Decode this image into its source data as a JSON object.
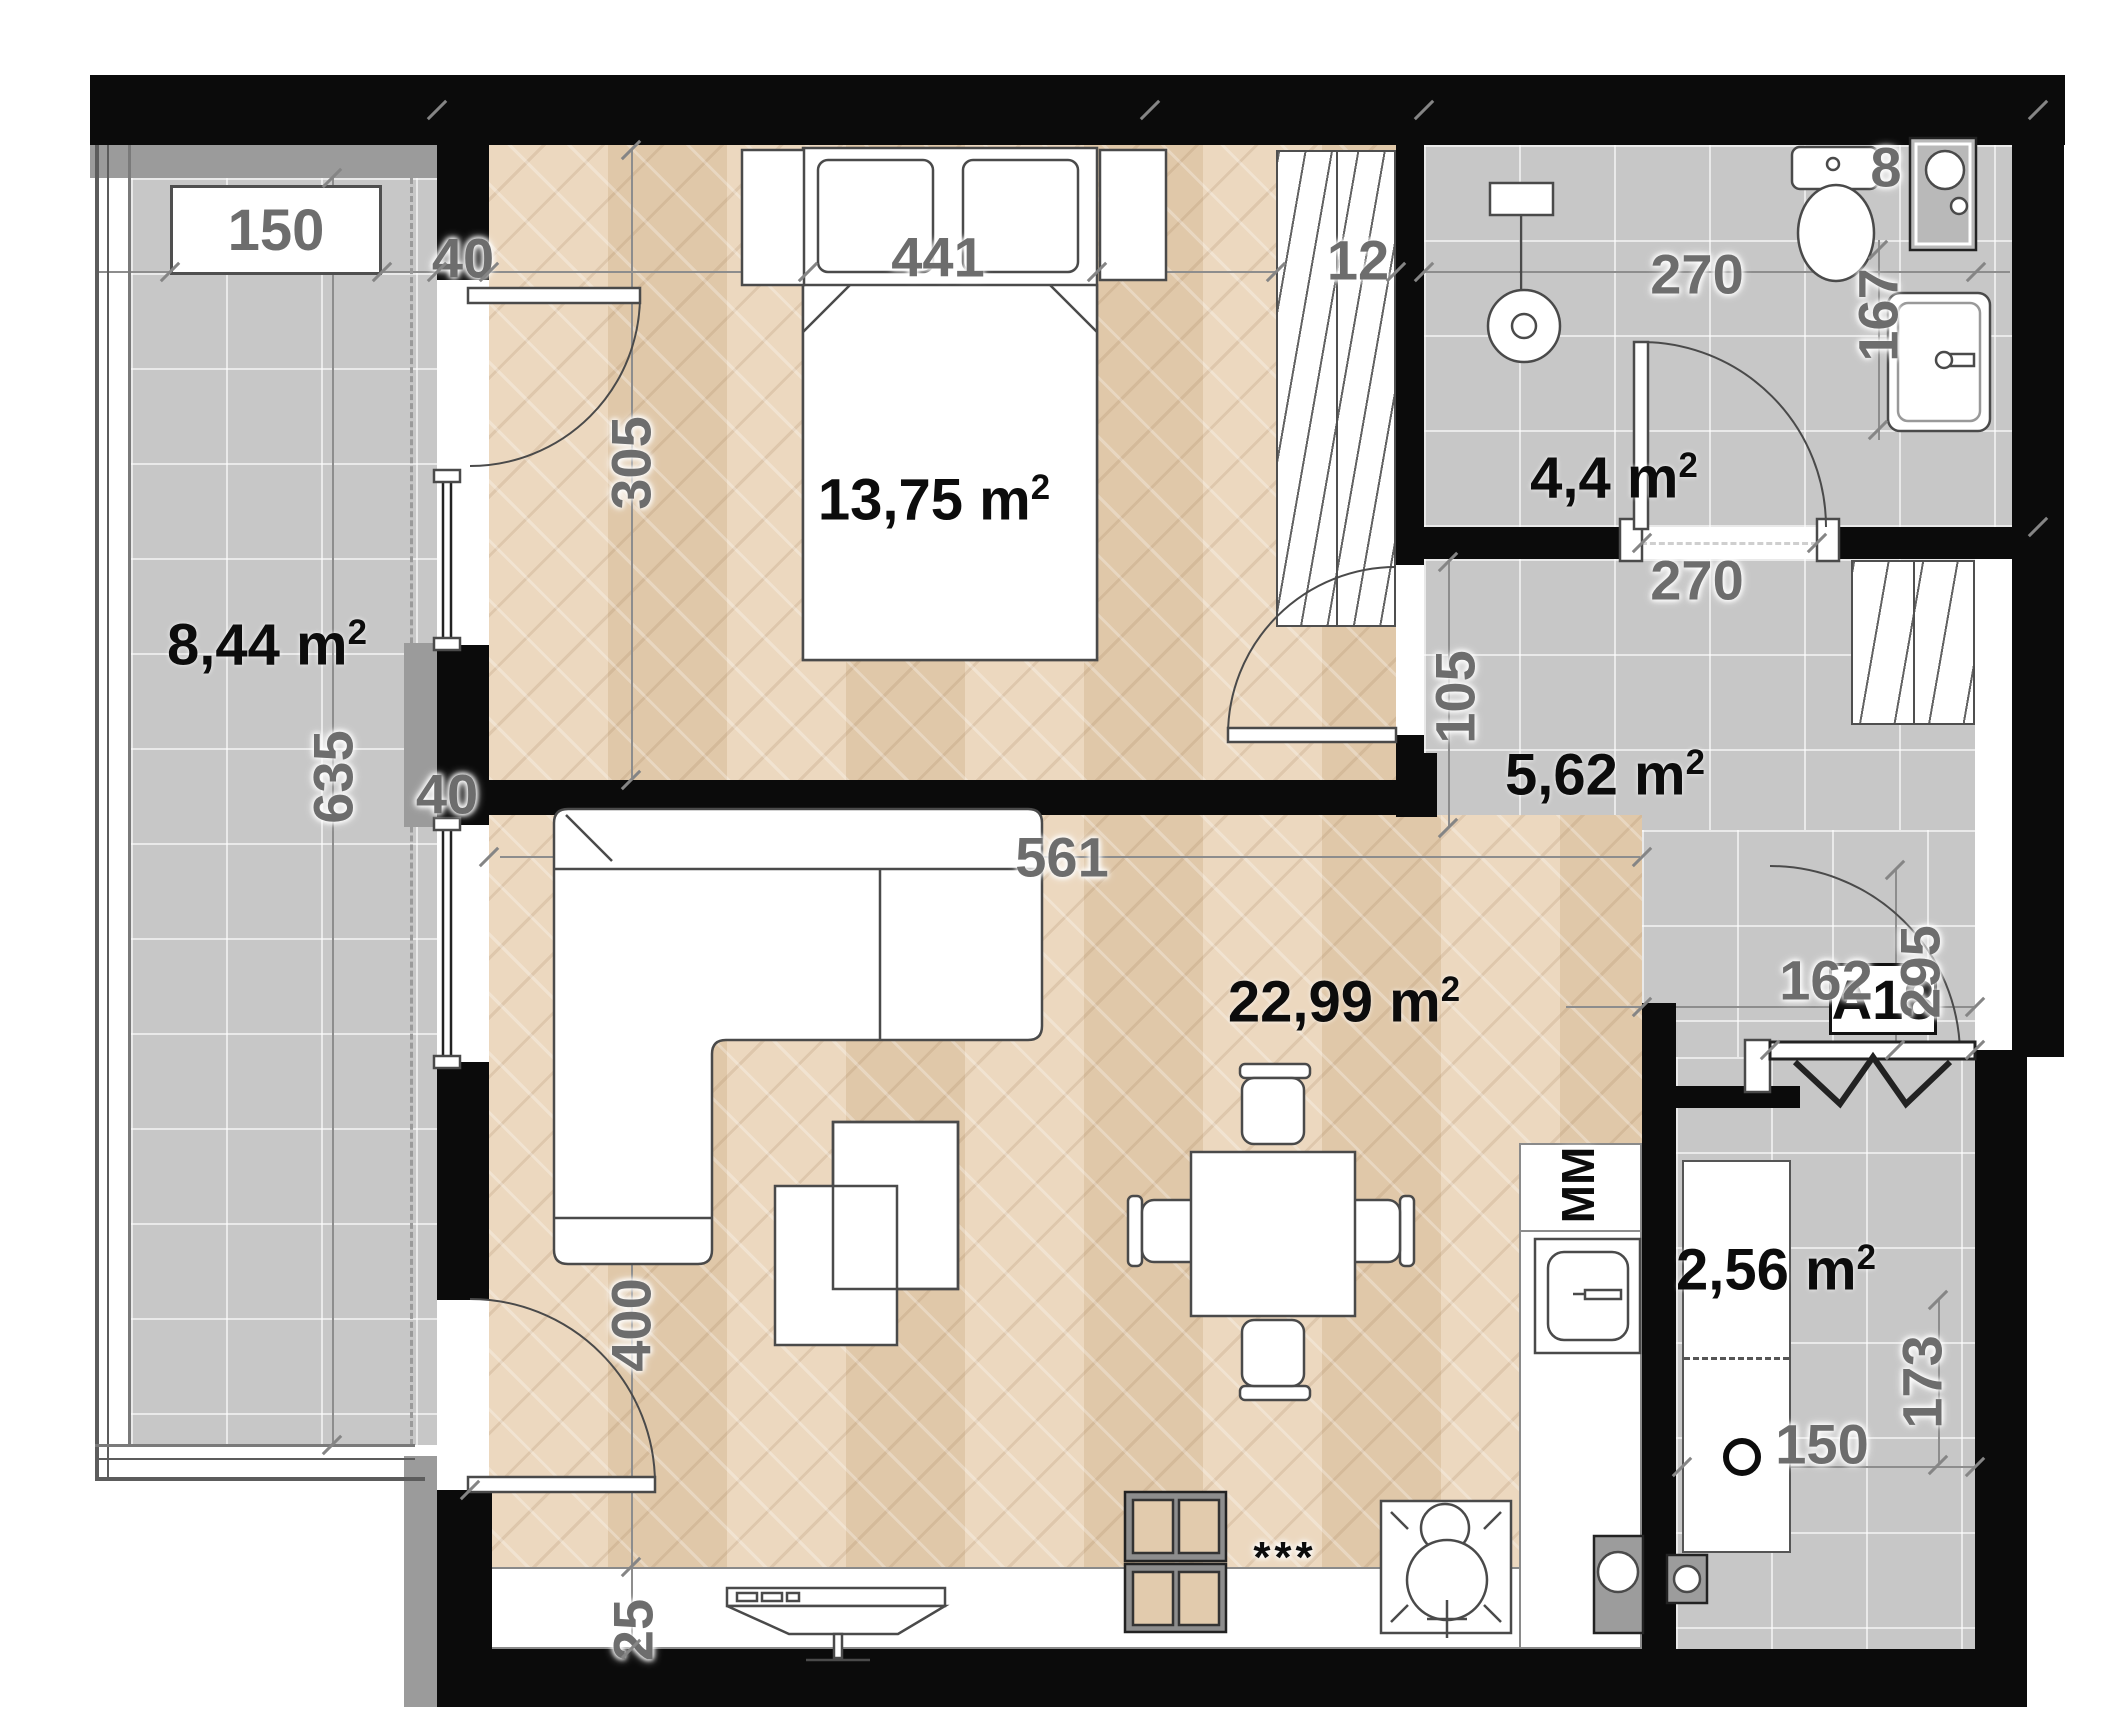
{
  "unit": {
    "label": "A18"
  },
  "balcony_box": {
    "label": "150"
  },
  "areas": {
    "balcony": "8,44",
    "bedroom": "13,75",
    "bathroom": "4,4",
    "hall": "5,62",
    "living": "22,99",
    "storage": "2,56"
  },
  "area_unit": {
    "base": "m",
    "sup": "2"
  },
  "dims": {
    "top_wall_40": "40",
    "bedroom_width": "441",
    "wardrobe_12": "12",
    "bathroom_width": "270",
    "toilet_8": "8",
    "basin_167": "167",
    "bedroom_height_305": "305",
    "balcony_height_635": "635",
    "mid_wall_40": "40",
    "bathroom_door_270": "270",
    "hall_105": "105",
    "hall_162": "162",
    "hall_295": "295",
    "living_width_561": "561",
    "living_height_400": "400",
    "kitchen_25": "25",
    "storage_width_150": "150",
    "storage_height_173": "173"
  },
  "labels": {
    "fridge": "MM",
    "cabinet_stars": "***"
  }
}
